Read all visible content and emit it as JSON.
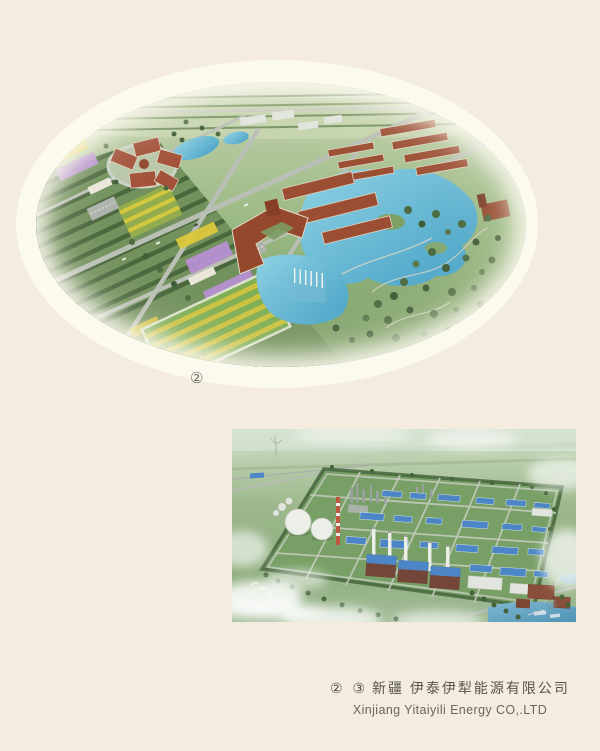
{
  "page": {
    "background": "#f3ecdf",
    "photo_ring": "#fcf9ef"
  },
  "campus_figure": {
    "marker": "②"
  },
  "plant_figure": {
    "marker": "③"
  },
  "caption": {
    "markers": "② ③",
    "company_zh": "新疆 伊泰伊犁能源有限公司",
    "company_en": "Xinjiang Yitaiyili Energy CO,.LTD"
  },
  "colors": {
    "caption_text": "#57544b",
    "water": "#5ab0d0",
    "campus_roof_red": "#9b4e31",
    "plant_roof_blue": "#4c86c6"
  }
}
